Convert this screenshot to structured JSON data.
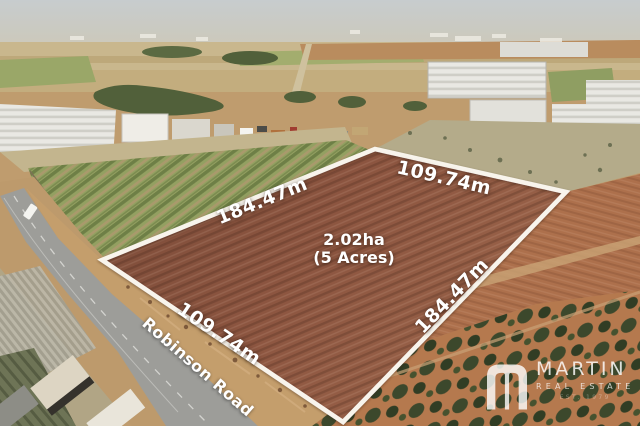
{
  "overlay": {
    "boundary": {
      "area_line1": "2.02ha",
      "area_line2": "(5 Acres)",
      "edge_top_right": "109.74m",
      "edge_top_left": "184.47m",
      "edge_bottom_right": "184.47m",
      "edge_bottom_left": "109.74m"
    },
    "road_label": "Robinson Road"
  },
  "branding": {
    "agency_name": "MARTIN",
    "agency_tagline": "REAL ESTATE",
    "agency_est": "EST. 1979"
  },
  "colors": {
    "boundary_line": "#f8f4ec",
    "parcel_soil": "#8a5540",
    "label_text": "#ffffff",
    "watermark": "rgba(255,255,255,0.8)"
  }
}
